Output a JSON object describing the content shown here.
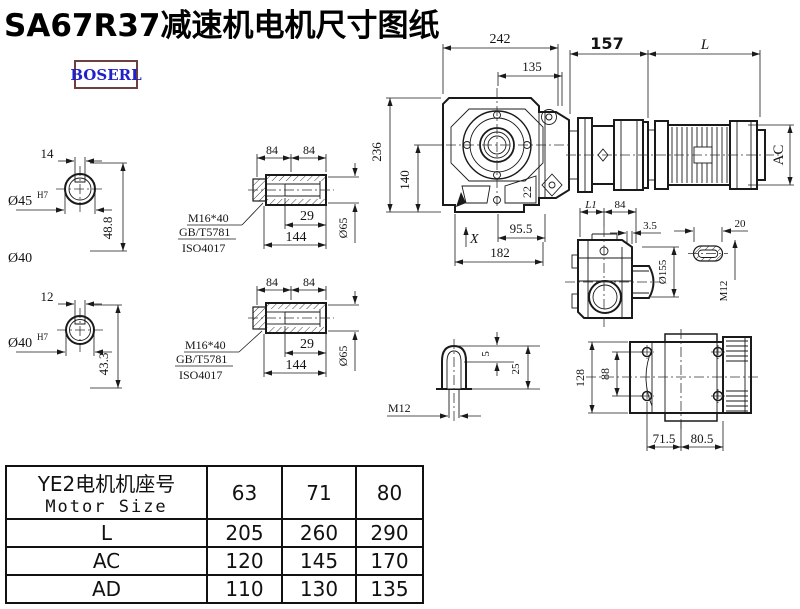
{
  "title": "SA67R37减速机电机尺寸图纸",
  "logo": "BOSERL",
  "colors": {
    "line": "#1a1a1a",
    "logo_text": "#2121cc",
    "logo_border": "#6e3f3f"
  },
  "views": {
    "shaft_a": {
      "key_width": "14",
      "dia": "Ø45",
      "tol": "H7",
      "depth": "48.8",
      "extra": "Ø40"
    },
    "shaft_b": {
      "key_width": "12",
      "dia": "Ø40",
      "tol": "H7",
      "depth": "43.3"
    },
    "bush_a": {
      "len_a": "84",
      "len_b": "84",
      "inner": "29",
      "total": "144",
      "dia": "Ø65",
      "bolt": "M16*40",
      "std1": "GB/T5781",
      "std2": "ISO4017"
    },
    "bush_b": {
      "len_a": "84",
      "len_b": "84",
      "inner": "29",
      "total": "144",
      "dia": "Ø65",
      "bolt": "M16*40",
      "std1": "GB/T5781",
      "std2": "ISO4017"
    },
    "front": {
      "overall_w": "242",
      "flange_w": "135",
      "overall_h": "236",
      "axis_h": "140",
      "angle": "22",
      "foot_a": "95.5",
      "foot_b": "182",
      "marker": "X"
    },
    "motor": {
      "adapter_len": "157",
      "motor_len": "L",
      "motor_dia": "AC"
    },
    "side": {
      "dim_l1": "L1",
      "dim_84": "84",
      "gap": "3.5",
      "flange_dia": "Ø155",
      "slot_w": "20",
      "thread": "M12"
    },
    "key": {
      "h1": "5",
      "h2": "25",
      "thread": "M12"
    },
    "top": {
      "overall": "128",
      "bolt_span": "88",
      "off_a": "71.5",
      "off_b": "80.5"
    }
  },
  "table": {
    "header_cn": "YE2电机机座号",
    "header_en": "Motor Size",
    "sizes": [
      "63",
      "71",
      "80"
    ],
    "rows": [
      {
        "label": "L",
        "values": [
          "205",
          "260",
          "290"
        ]
      },
      {
        "label": "AC",
        "values": [
          "120",
          "145",
          "170"
        ]
      },
      {
        "label": "AD",
        "values": [
          "110",
          "130",
          "135"
        ]
      }
    ]
  }
}
